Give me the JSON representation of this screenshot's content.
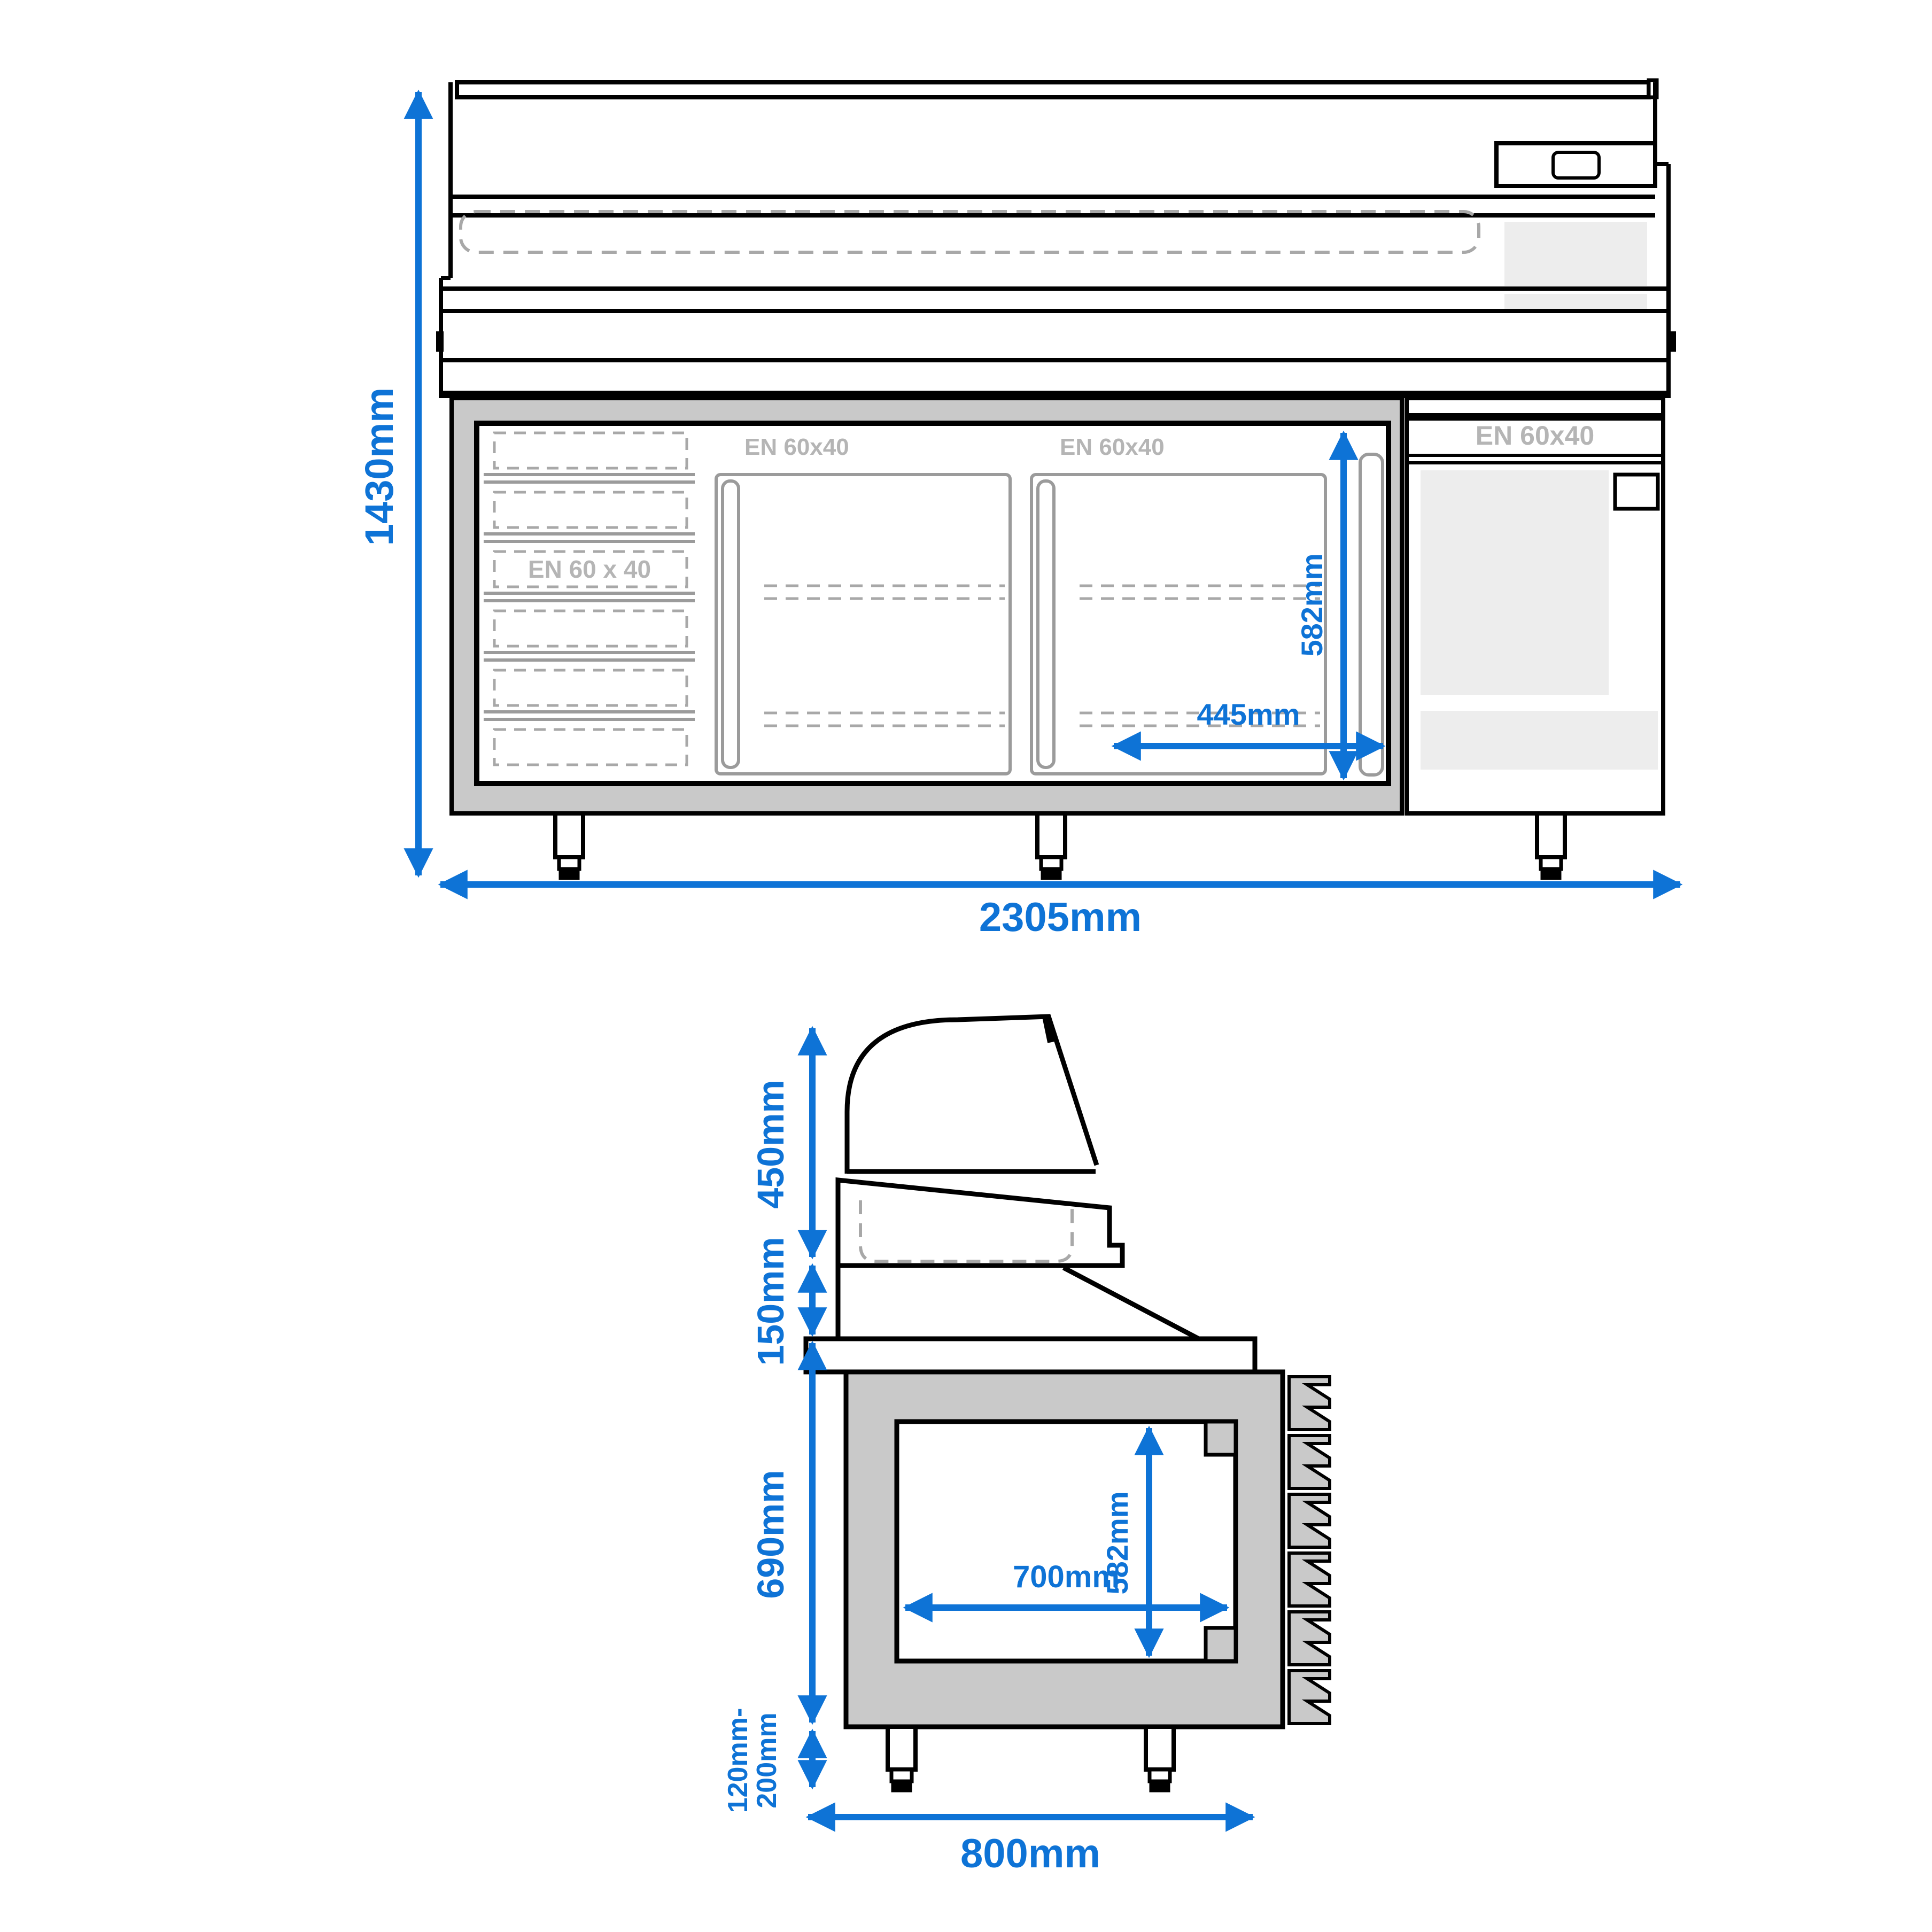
{
  "title": "Refrigerated pizza prep counter technical drawing",
  "colors": {
    "dimension_blue": "#0e73d6",
    "outline_black": "#000000",
    "wall_gray": "#c9c9c9",
    "panel_light_gray": "#ededed",
    "detail_gray": "#9b9b9b",
    "dash_gray": "#a8a8a8",
    "rack_label_gray": "#b5b5b5"
  },
  "front_view": {
    "dimensions": {
      "overall_height": "1430mm",
      "overall_width": "2305mm",
      "interior_height": "582mm",
      "door_opening_width": "445mm"
    },
    "labels": {
      "drawer_rack": "EN 60 x 40",
      "left_door_rack": "EN 60x40",
      "right_door_rack": "EN 60x40",
      "side_module_rack": "EN 60x40"
    }
  },
  "side_view": {
    "dimensions": {
      "display_height": "450mm",
      "riser_height": "150mm",
      "body_height": "690mm",
      "feet_height_line1": "120mm-",
      "feet_height_line2": "200mm",
      "overall_depth": "800mm",
      "interior_depth": "700mm",
      "interior_height": "582mm"
    }
  }
}
